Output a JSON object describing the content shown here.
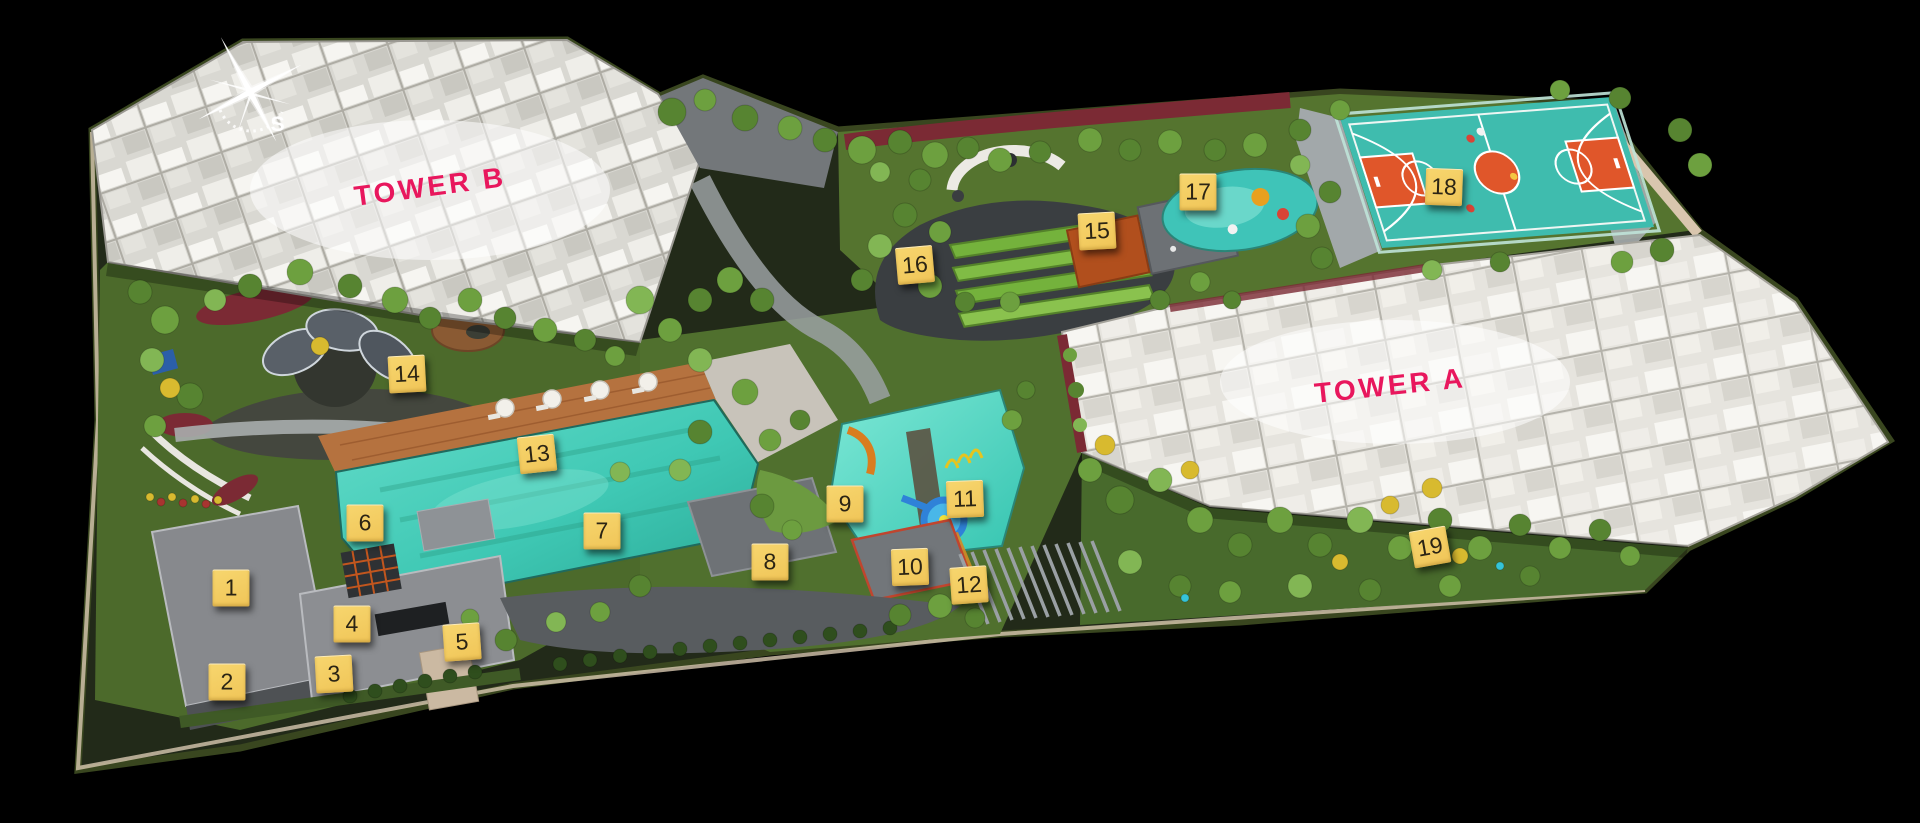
{
  "canvas": {
    "width_px": 1920,
    "height_px": 823,
    "background": "#000000"
  },
  "palette": {
    "marker_yellow": "#F0C558",
    "marker_yellow_light": "#F7D66E",
    "marker_text": "#2B2414",
    "label_pink": "#E8175D",
    "pool_teal": "#3FC8B4",
    "court_teal": "#3FBCAE",
    "court_orange": "#E0562A",
    "compass_white": "#FFFFFF"
  },
  "labels": {
    "color": "#E8175D",
    "items": [
      {
        "id": "tower-b",
        "text": "TOWER B",
        "x_pct": 22.4,
        "y_pct": 22.7,
        "rot_deg": -7.5,
        "font_px": 28
      },
      {
        "id": "tower-a",
        "text": "TOWER A",
        "x_pct": 72.4,
        "y_pct": 46.9,
        "rot_deg": -6,
        "font_px": 28
      }
    ]
  },
  "compass": {
    "south_label": "S"
  },
  "markers": {
    "style": {
      "size_px": 37,
      "background": "#F0C558",
      "background_light": "#F7D66E",
      "text_color": "#2B2414"
    },
    "items": [
      {
        "number": "1",
        "x_pct": 12.03,
        "y_pct": 71.45,
        "rot_deg": 0
      },
      {
        "number": "2",
        "x_pct": 11.82,
        "y_pct": 82.87,
        "rot_deg": 0
      },
      {
        "number": "3",
        "x_pct": 17.4,
        "y_pct": 81.9,
        "rot_deg": -3
      },
      {
        "number": "4",
        "x_pct": 18.33,
        "y_pct": 75.82,
        "rot_deg": 0
      },
      {
        "number": "5",
        "x_pct": 24.06,
        "y_pct": 78.01,
        "rot_deg": -4
      },
      {
        "number": "6",
        "x_pct": 19.01,
        "y_pct": 63.55,
        "rot_deg": 0
      },
      {
        "number": "7",
        "x_pct": 31.35,
        "y_pct": 64.52,
        "rot_deg": 0
      },
      {
        "number": "8",
        "x_pct": 40.1,
        "y_pct": 68.29,
        "rot_deg": 0
      },
      {
        "number": "9",
        "x_pct": 44.01,
        "y_pct": 61.24,
        "rot_deg": 0
      },
      {
        "number": "10",
        "x_pct": 47.4,
        "y_pct": 68.89,
        "rot_deg": -2
      },
      {
        "number": "11",
        "x_pct": 50.26,
        "y_pct": 60.63,
        "rot_deg": -2
      },
      {
        "number": "12",
        "x_pct": 50.47,
        "y_pct": 71.08,
        "rot_deg": -4
      },
      {
        "number": "13",
        "x_pct": 27.97,
        "y_pct": 55.16,
        "rot_deg": -6
      },
      {
        "number": "14",
        "x_pct": 21.2,
        "y_pct": 45.44,
        "rot_deg": -3
      },
      {
        "number": "15",
        "x_pct": 57.14,
        "y_pct": 28.07,
        "rot_deg": -3
      },
      {
        "number": "16",
        "x_pct": 47.66,
        "y_pct": 32.2,
        "rot_deg": -5
      },
      {
        "number": "17",
        "x_pct": 62.4,
        "y_pct": 23.33,
        "rot_deg": 0
      },
      {
        "number": "18",
        "x_pct": 75.21,
        "y_pct": 22.72,
        "rot_deg": 2
      },
      {
        "number": "19",
        "x_pct": 74.48,
        "y_pct": 66.46,
        "rot_deg": -10
      }
    ]
  }
}
